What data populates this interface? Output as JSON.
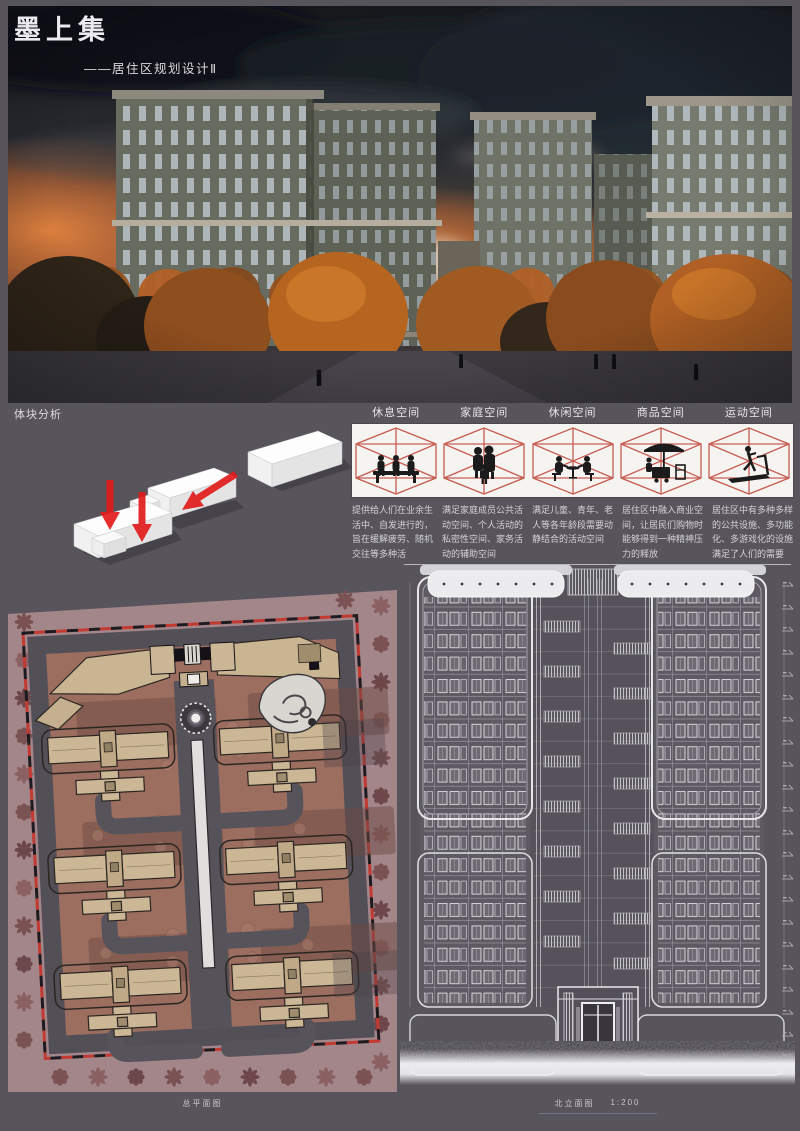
{
  "header": {
    "title": "墨上集",
    "subtitle": "——居住区规划设计Ⅱ"
  },
  "analysis": {
    "section_label": "体块分析",
    "spaces": [
      {
        "label": "休息空间",
        "icon": "bench-people-icon",
        "desc": "提供给人们在业余生活中、自发进行的，旨在缓解疲劳、随机交往等多种活"
      },
      {
        "label": "家庭空间",
        "icon": "family-group-icon",
        "desc": "满足家庭成员公共活动空间、个人活动的私密性空间、家务活动的辅助空间"
      },
      {
        "label": "休闲空间",
        "icon": "table-gathering-icon",
        "desc": "满足儿童、青年、老人等各年龄段需要动静结合的活动空间"
      },
      {
        "label": "商品空间",
        "icon": "market-stall-icon",
        "desc": "居住区中融入商业空间，让居民们购物时能够得到一种精神压力的释放"
      },
      {
        "label": "运动空间",
        "icon": "treadmill-icon",
        "desc": "居住区中有多种多样的公共设施、多功能化、多游戏化的设施满足了人们的需要"
      }
    ]
  },
  "drawings": {
    "site_plan_caption": "总平面图",
    "elevation_caption": "北立面图",
    "elevation_scale": "1:200"
  },
  "icons": {
    "space_icons": [
      "bench-people-icon",
      "family-group-icon",
      "table-gathering-icon",
      "market-stall-icon",
      "treadmill-icon"
    ],
    "arrow": "red-arrow-icon",
    "tree": "tree-icon",
    "level_marker": "level-marker-icon"
  },
  "colors": {
    "page_bg": "#57545C",
    "panel_white": "#F6F4F1",
    "wireframe_red": "#C4554B",
    "arrow_red": "#E21C1C",
    "plan_background": "#A2868A",
    "plan_field": "#9B6E60",
    "building_tan": "#CBB795",
    "sunset_orange": "#D07038",
    "line_white": "#E6E5E9",
    "text_light": "#D4D2D8"
  }
}
